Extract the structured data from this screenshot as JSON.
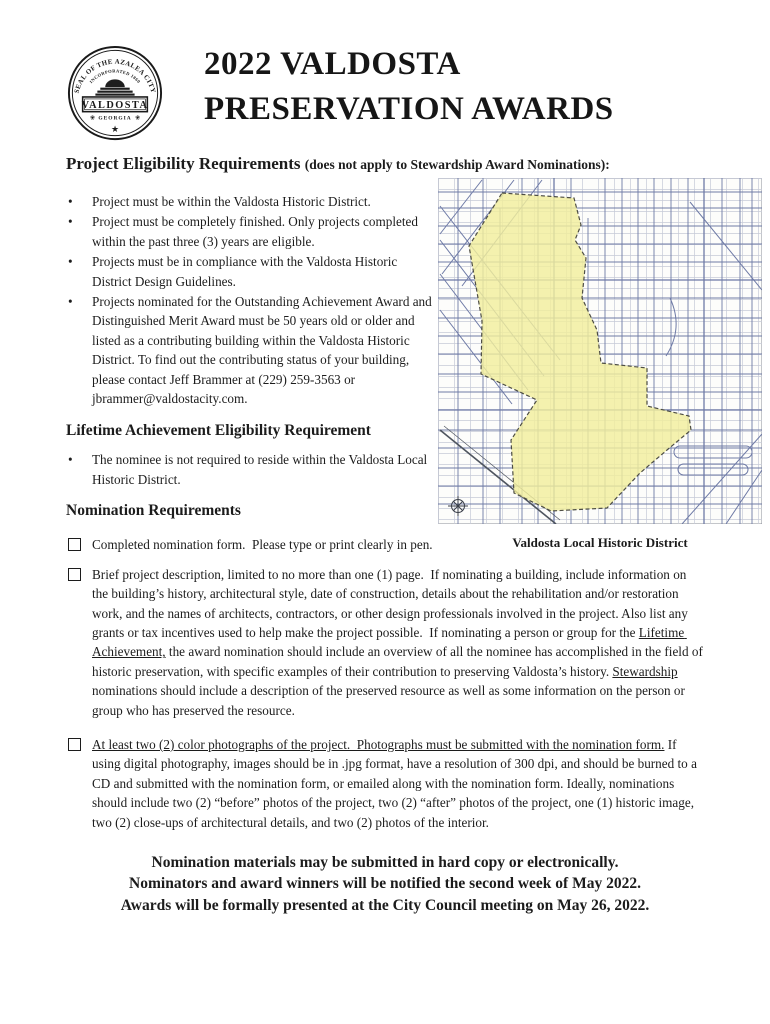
{
  "page": {
    "title_line1": "2022 VALDOSTA",
    "title_line2": "PRESERVATION AWARDS"
  },
  "logo": {
    "seal_top_text": "SEAL OF THE AZALEA CITY",
    "seal_sub_text": "INCORPORATED 1860",
    "seal_name": "VALDOSTA",
    "seal_state": "GEORGIA",
    "seal_star": "★"
  },
  "eligibility": {
    "heading": "Project Eligibility Requirements ",
    "heading_note": "(does not apply to Stewardship Award Nominations):",
    "bullets": [
      "Project must be within the Valdosta Historic District.",
      "Project must be completely finished. Only projects completed within the past three (3) years are eligible.",
      "Projects must be in compliance with the Valdosta Historic District Design Guidelines.",
      "Projects nominated for the Outstanding Achievement Award and Distinguished Merit Award must be 50 years old or older and listed as a contributing building within the Valdosta Historic District. To find out the contributing status of your building, please contact Jeff Brammer at (229) 259-3563 or jbrammer@valdostacity.com."
    ]
  },
  "lifetime": {
    "heading": "Lifetime Achievement Eligibility Requirement",
    "bullet": "The nominee is not required to reside within the Valdosta Local Historic District."
  },
  "nomination": {
    "heading": "Nomination Requirements",
    "items": [
      {
        "segments": [
          {
            "text": "Completed nomination form.  Please type or print clearly in pen."
          }
        ]
      },
      {
        "segments": [
          {
            "text": "Brief project description, limited to no more than one (1) page.  If nominating a building, include information on the building’s history, architectural style, date of construction, details about the rehabilitation and/or restoration work, and the names of architects, contractors, or other design professionals involved in the project. Also list any grants or tax incentives used to help make the project possible.  If nominating a person or group for the "
          },
          {
            "text": "Lifetime Achievement,",
            "underline": true
          },
          {
            "text": " the award nomination should include an overview of all the nominee has accomplished in the field of historic preservation, with specific examples of their contribution to preserving Valdosta’s history. "
          },
          {
            "text": "Stewardship",
            "underline": true
          },
          {
            "text": " nominations should include a description of the preserved resource as well as some information on the person or group who has preserved the resource."
          }
        ]
      },
      {
        "segments": [
          {
            "text": "At least two (2) color photographs of the project.  Photographs must be submitted with the nomination form.",
            "underline": true
          },
          {
            "text": " If using digital photography, images should be in .jpg format, have a resolution of 300 dpi, and should be burned to a CD and submitted with the nomination form, or emailed along with the nomination form. Ideally, nominations should include two (2) “before” photos of the project, two (2) “after” photos of the project, one (1) historic image,  two (2) close-ups of architectural details, and two (2) photos of the interior."
          }
        ]
      }
    ]
  },
  "map": {
    "caption": "Valdosta Local Historic District",
    "district_fill": "#f2ee9c",
    "street_color": "#6e7aa6"
  },
  "footer": {
    "lines": [
      "Nomination materials may be submitted in hard copy or electronically.",
      "Nominators and award winners will be notified the second week of May 2022.",
      "Awards will be formally presented at the City Council meeting on May 26, 2022."
    ]
  }
}
